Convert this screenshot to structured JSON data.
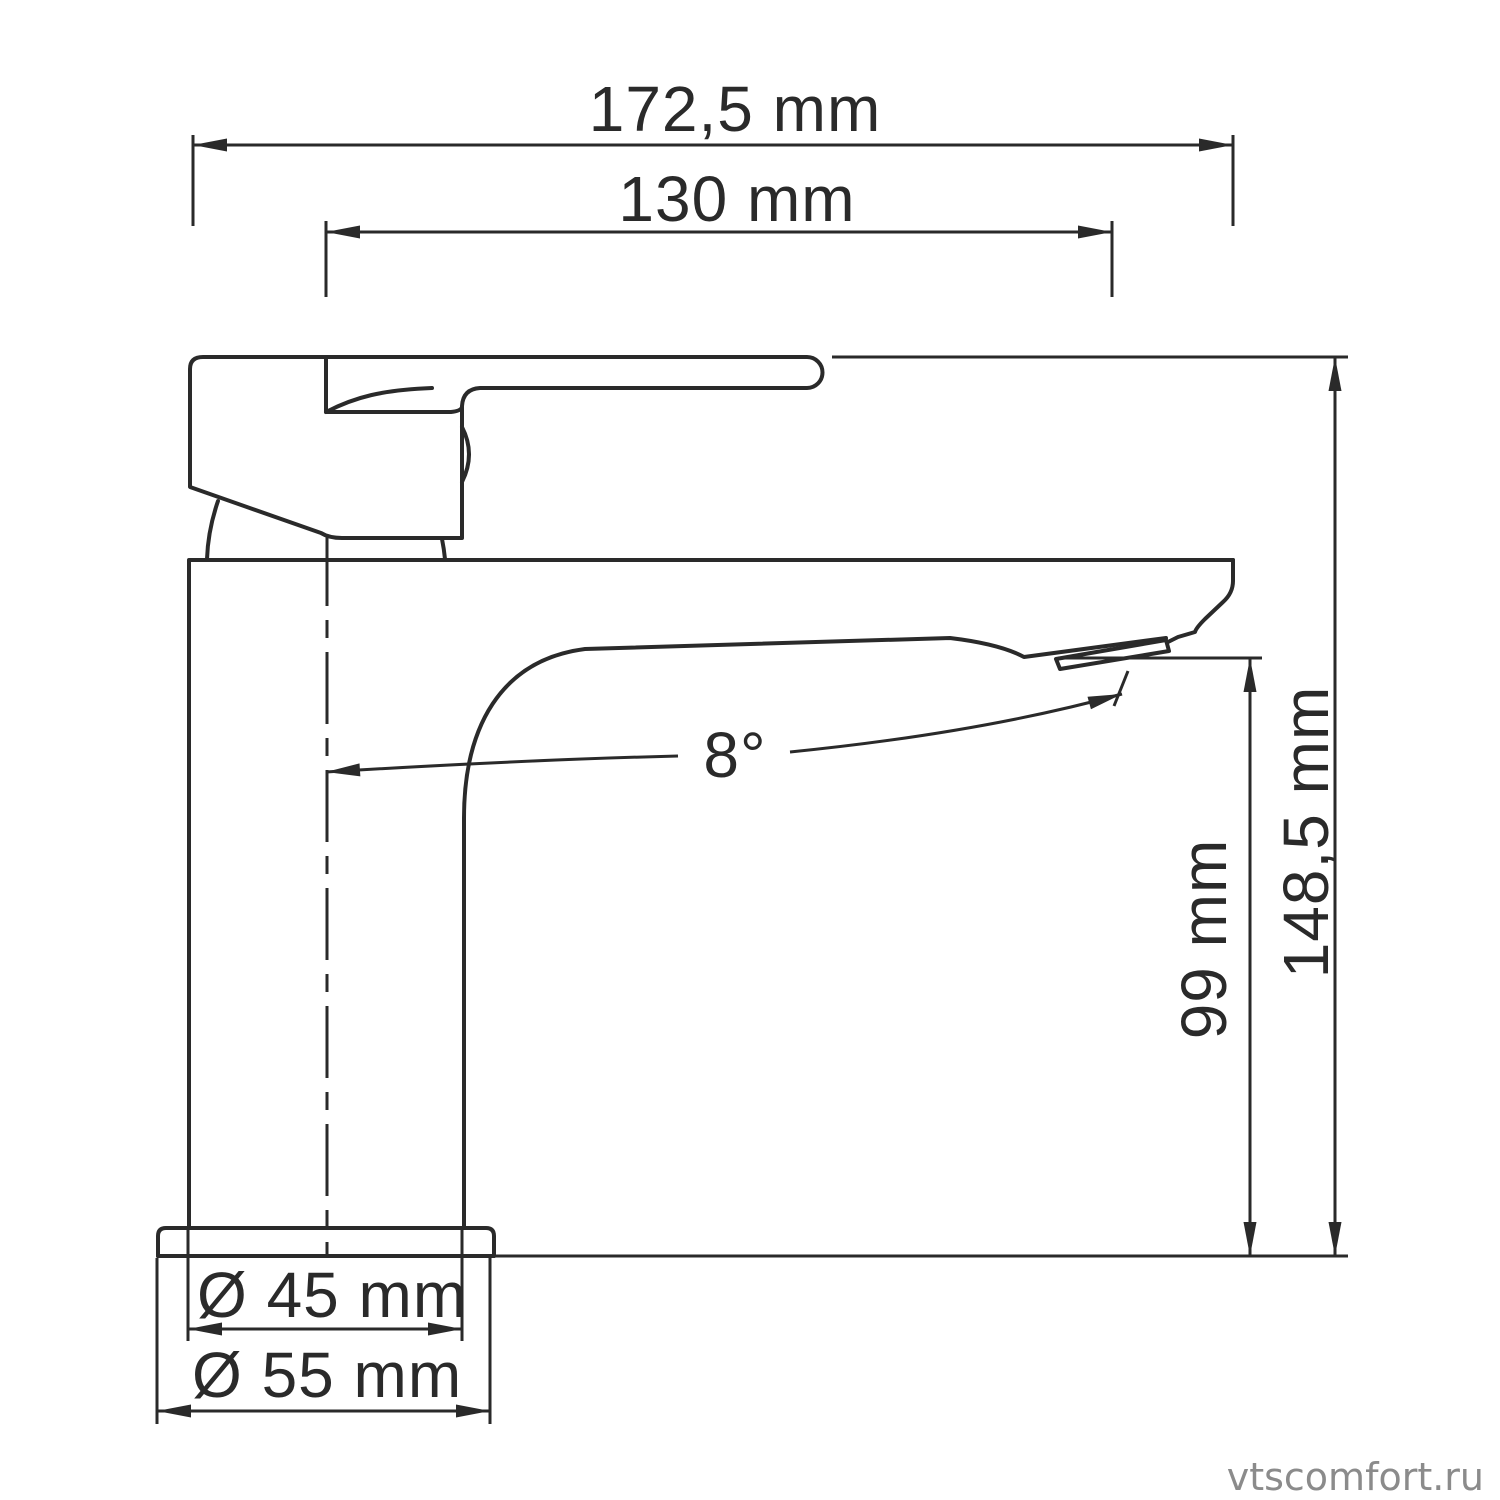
{
  "title": "Basin faucet technical drawing",
  "drawing": {
    "dimensions": {
      "overall_width": "172,5 mm",
      "spout_reach": "130 mm",
      "spout_angle": "8°",
      "spout_height": "99 mm",
      "overall_height": "148,5 mm",
      "body_diameter": "Ø 45 mm",
      "base_diameter": "Ø 55 mm"
    },
    "colors": {
      "line": "#2a2a2a",
      "watermark": "#8b8b8b",
      "background": "#ffffff"
    }
  },
  "watermark": "vtscomfort.ru"
}
